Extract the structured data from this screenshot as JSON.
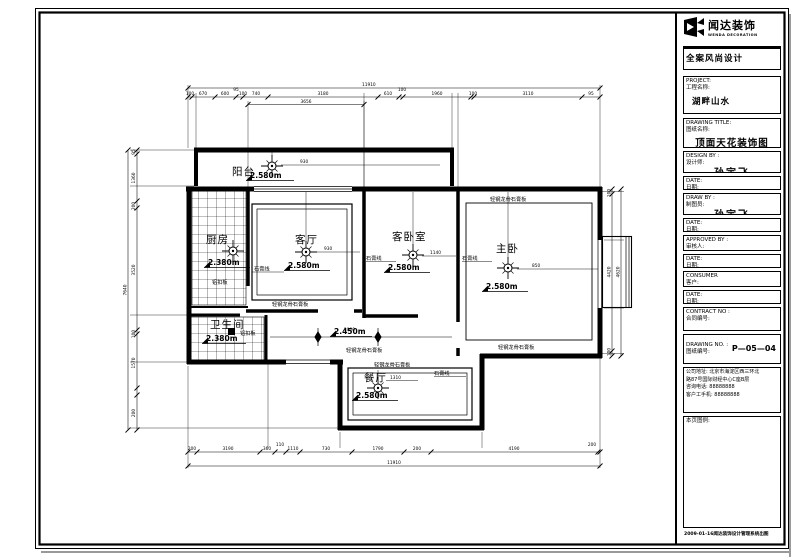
{
  "title_block": {
    "logo_cn": "闻达装饰",
    "logo_en": "WENDA DECORATION",
    "slogan": "全案风尚设计",
    "fields": [
      {
        "label": "PROJECT:",
        "label_cn": "工程名称:",
        "value": "湖畔山水"
      },
      {
        "label": "DRAWING TITLE:",
        "label_cn": "图纸名称:",
        "value": "顶面天花装饰图"
      },
      {
        "label": "DESIGN BY :",
        "label_cn": "设计师:",
        "value": "孙宇飞"
      },
      {
        "label": "DATE:",
        "label_cn": "日期:",
        "value": ""
      },
      {
        "label": "DRAW BY :",
        "label_cn": "制图员:",
        "value": "孙宇飞"
      },
      {
        "label": "DATE:",
        "label_cn": "日期:",
        "value": ""
      },
      {
        "label": "APPROVED BY :",
        "label_cn": "审核人:",
        "value": ""
      },
      {
        "label": "DATE:",
        "label_cn": "日期:",
        "value": ""
      },
      {
        "label": "CONSUMER",
        "label_cn": "客户:",
        "value": ""
      },
      {
        "label": "DATE:",
        "label_cn": "日期:",
        "value": ""
      },
      {
        "label": "CONTRACT NO :",
        "label_cn": "合同编号:",
        "value": ""
      },
      {
        "label": "DRAWING NO. :",
        "label_cn": "图纸编号:",
        "value": "P—05—04"
      }
    ],
    "company_lines": {
      "l1": "公司地址: 北京市海淀区西三环北",
      "l2": "路87号国际财经中心C座B层",
      "l3": "咨询电话: 88888888",
      "l4": "客户工手机: 88888888"
    },
    "legend_label": "本页图例:",
    "footer": "2009-01-16闻达装饰设计管理系统出图"
  },
  "plan": {
    "rooms": {
      "balcony": {
        "name": "阳台",
        "height": "2.580m"
      },
      "kitchen": {
        "name": "厨房",
        "height": "2.380m",
        "material": "铝扣板"
      },
      "living": {
        "name": "客厅",
        "height": "2.580m",
        "molding": "石膏线",
        "ceiling": "轻钢龙骨石膏板"
      },
      "guest": {
        "name": "客卧室",
        "height": "2.580m",
        "molding": "石膏线"
      },
      "master": {
        "name": "主卧",
        "height": "2.580m",
        "molding": "石膏线",
        "ceiling_top": "轻钢龙骨石膏板",
        "ceiling_bottom": "轻钢龙骨石膏板"
      },
      "bath": {
        "name": "卫生间",
        "height": "2.380m",
        "material": "铝扣板"
      },
      "hall": {
        "height": "2.450m",
        "ceiling": "轻钢龙骨石膏板",
        "dim": "1000"
      },
      "dining": {
        "name": "餐厅",
        "height": "2.580m",
        "molding": "石膏线",
        "ceiling": "轻钢龙骨石膏板"
      }
    },
    "leader_dims": {
      "balcony": "930",
      "living": "930",
      "guest": "1140",
      "master": "850",
      "dining": "1310"
    },
    "dims": {
      "top_overall": "11910",
      "top_segments": [
        "100",
        "670",
        "600",
        "95",
        "100",
        "740",
        "3180",
        "610",
        "100",
        "1960",
        "100",
        "3110",
        "95"
      ],
      "top_sub": "3656",
      "bottom_segments": [
        "200",
        "3190",
        "360",
        "110",
        "1110",
        "730",
        "1790",
        "200",
        "4190",
        "200"
      ],
      "bottom_overall": "11910",
      "left_overall": "7640",
      "left_segments": [
        "95",
        "1360",
        "200",
        "3520",
        "100",
        "1570",
        "200"
      ],
      "right_segments": [
        "100",
        "4420",
        "100"
      ],
      "right_overall": "4620"
    }
  }
}
